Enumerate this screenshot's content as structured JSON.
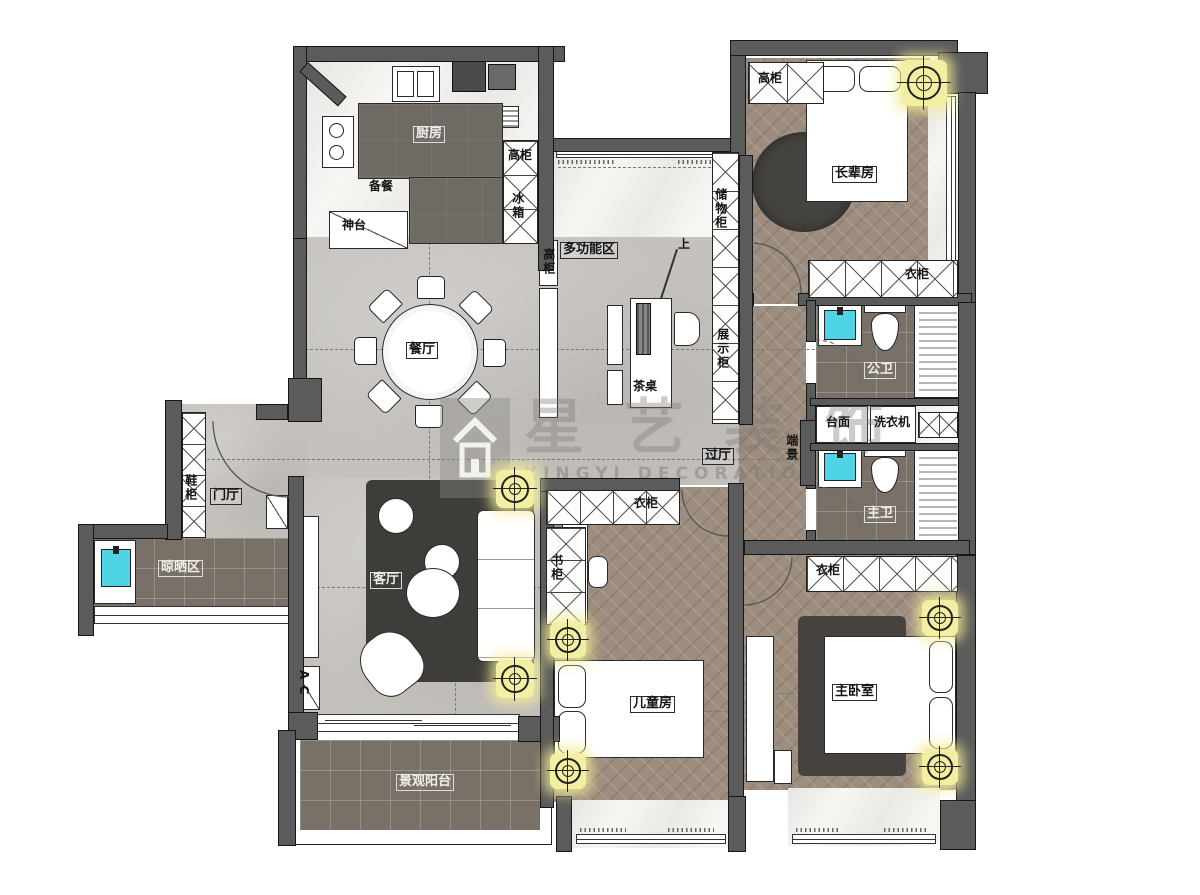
{
  "watermark": {
    "brand": "星艺装饰",
    "sub": "XINGYI DECORATION"
  },
  "labels": {
    "kitchen": "厨房",
    "prep": "备餐",
    "altar": "神台",
    "kitchen_tall_cabinet": "高柜",
    "fridge": "冰箱",
    "console_tall_cabinet": "高柜",
    "multifunction": "多功能区",
    "stair_up": "上",
    "storage_cabinet": "储物柜",
    "display_cabinet": "展示柜",
    "elder_room": "长辈房",
    "elder_tall_cabinet": "高柜",
    "elder_wardrobe": "衣柜",
    "public_bath": "公卫",
    "counter": "台面",
    "washing_machine": "洗衣机",
    "end_scene": "端景",
    "master_bath": "主卫",
    "dining_room": "餐厅",
    "tea_table": "茶桌",
    "hallway": "过厅",
    "foyer": "门厅",
    "shoe_cabinet": "鞋柜",
    "drying_area": "晾晒区",
    "living_room": "客厅",
    "ac_unit": "A C",
    "children_wardrobe": "衣柜",
    "bookcase": "书柜",
    "children_room": "儿童房",
    "master_bedroom": "主卧室",
    "master_wardrobe": "衣柜",
    "balcony": "景观阳台"
  },
  "colors": {
    "wall": "#5b5b5b",
    "floor_concrete": "#c5c2be",
    "floor_wood": "#9c8d7f",
    "floor_dark_tile": "#797068",
    "floor_marble": "#f7f6f3",
    "sink_accent": "#4fd4e6",
    "light_glow": "#f3efa2",
    "rug_dark": "#3f3d3a",
    "watermark_gray": "#8a8784"
  }
}
